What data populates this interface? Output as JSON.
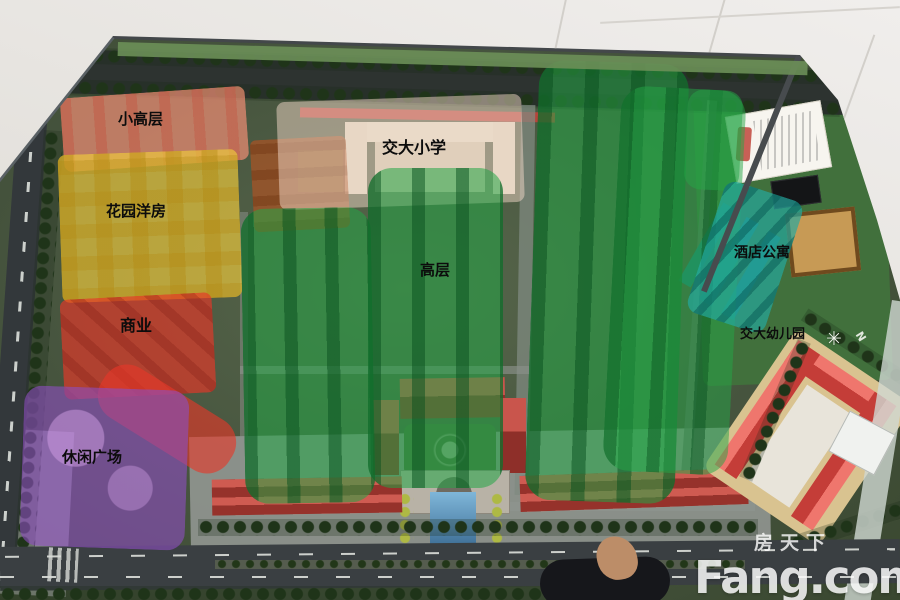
{
  "zones": [
    {
      "key": "xiaogaoceng",
      "label": "小高层",
      "color": "#eb8f7a"
    },
    {
      "key": "huayuanyangfang",
      "label": "花园洋房",
      "color": "#eec83c"
    },
    {
      "key": "shangye",
      "label": "商业",
      "color": "#e6372b"
    },
    {
      "key": "xiuxianguangchang",
      "label": "休闲广场",
      "color": "#8d4fc4"
    },
    {
      "key": "jiaodaxiaoxue",
      "label": "交大小学",
      "color": "#f2d8c8"
    },
    {
      "key": "gaoceng",
      "label": "高层",
      "color": "#23a84e"
    },
    {
      "key": "jiudiangongyu",
      "label": "酒店公寓",
      "color": "#23a89f"
    },
    {
      "key": "jiaodayoueryuan",
      "label": "交大幼儿园",
      "color": "#e2574d"
    }
  ],
  "compass": {
    "label": "N",
    "icon": "✳"
  },
  "watermark": {
    "cn": "房天下",
    "en": "Fang.com"
  }
}
